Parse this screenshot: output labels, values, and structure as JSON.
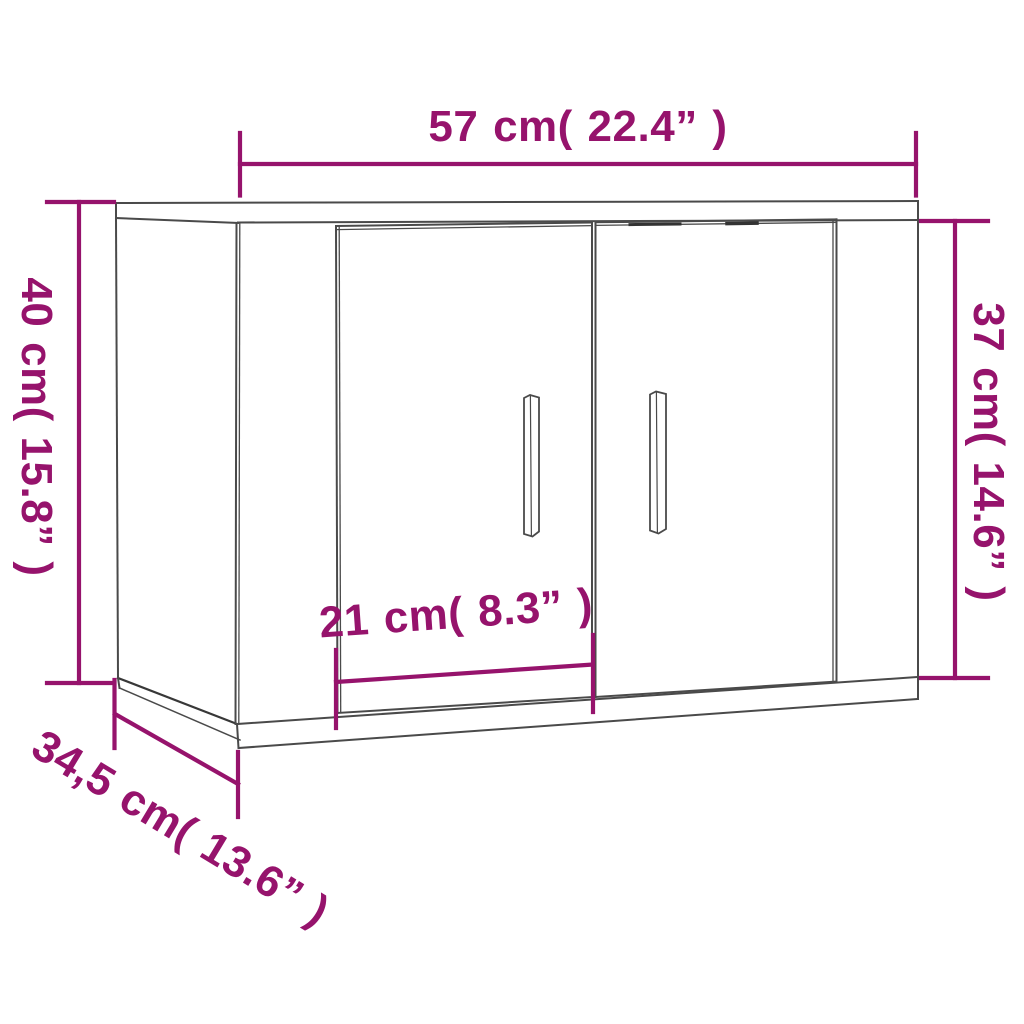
{
  "diagram": {
    "colors": {
      "dimension_accent": "#96136C",
      "outline": "#4A4A4A",
      "background": "#FFFFFF"
    },
    "dimensions": {
      "width": {
        "label": "57 cm( 22.4” )",
        "cm": "57",
        "inches": "22.4"
      },
      "height_back": {
        "label": "40 cm( 15.8” )",
        "cm": "40",
        "inches": "15.8"
      },
      "height_front": {
        "label": "37 cm( 14.6” )",
        "cm": "37",
        "inches": "14.6"
      },
      "door_width": {
        "label": "21 cm( 8.3” )",
        "cm": "21",
        "inches": "8.3"
      },
      "depth": {
        "label": "34,5 cm( 13.6” )",
        "cm": "34,5",
        "inches": "13.6"
      }
    }
  }
}
